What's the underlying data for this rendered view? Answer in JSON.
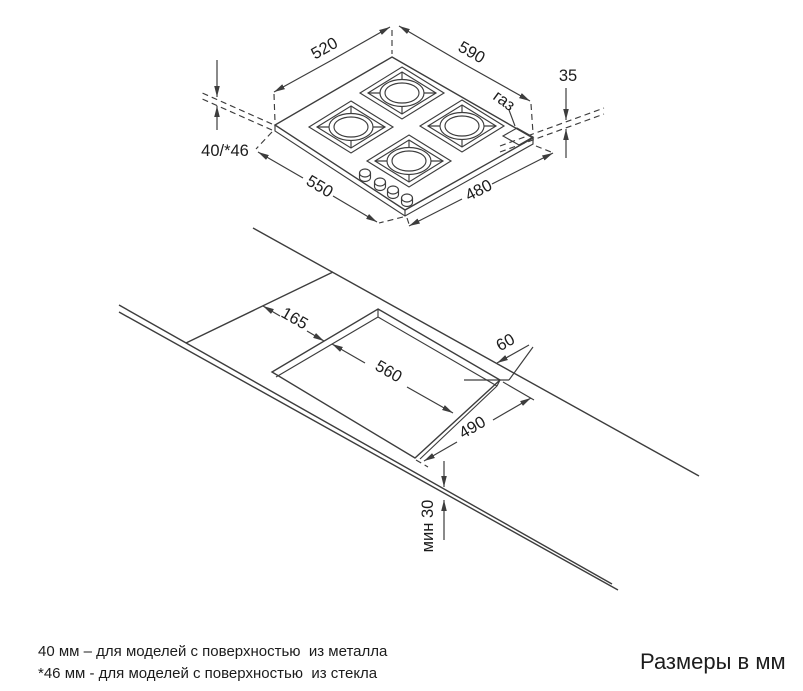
{
  "diagram": {
    "hob": {
      "dim_back_edge": "520",
      "dim_right_edge": "590",
      "dim_height_above_counter": "35",
      "dim_body_depth": "40/*46",
      "dim_front_left_edge": "550",
      "dim_front_right_edge": "480",
      "gas_connection_label": "газ"
    },
    "worktop": {
      "dim_left_offset": "165",
      "dim_cutout_width": "560",
      "dim_rear_clearance": "60",
      "dim_cutout_depth": "490",
      "dim_min_front_gap": "мин 30"
    }
  },
  "footnotes": {
    "metal": "40 мм – для моделей с поверхностью  из металла",
    "glass": "*46 мм - для моделей с поверхностью  из стекла"
  },
  "caption": "Размеры в мм",
  "colors": {
    "line": "#3d3d3d",
    "text": "#1c1c1c",
    "background": "#ffffff"
  }
}
